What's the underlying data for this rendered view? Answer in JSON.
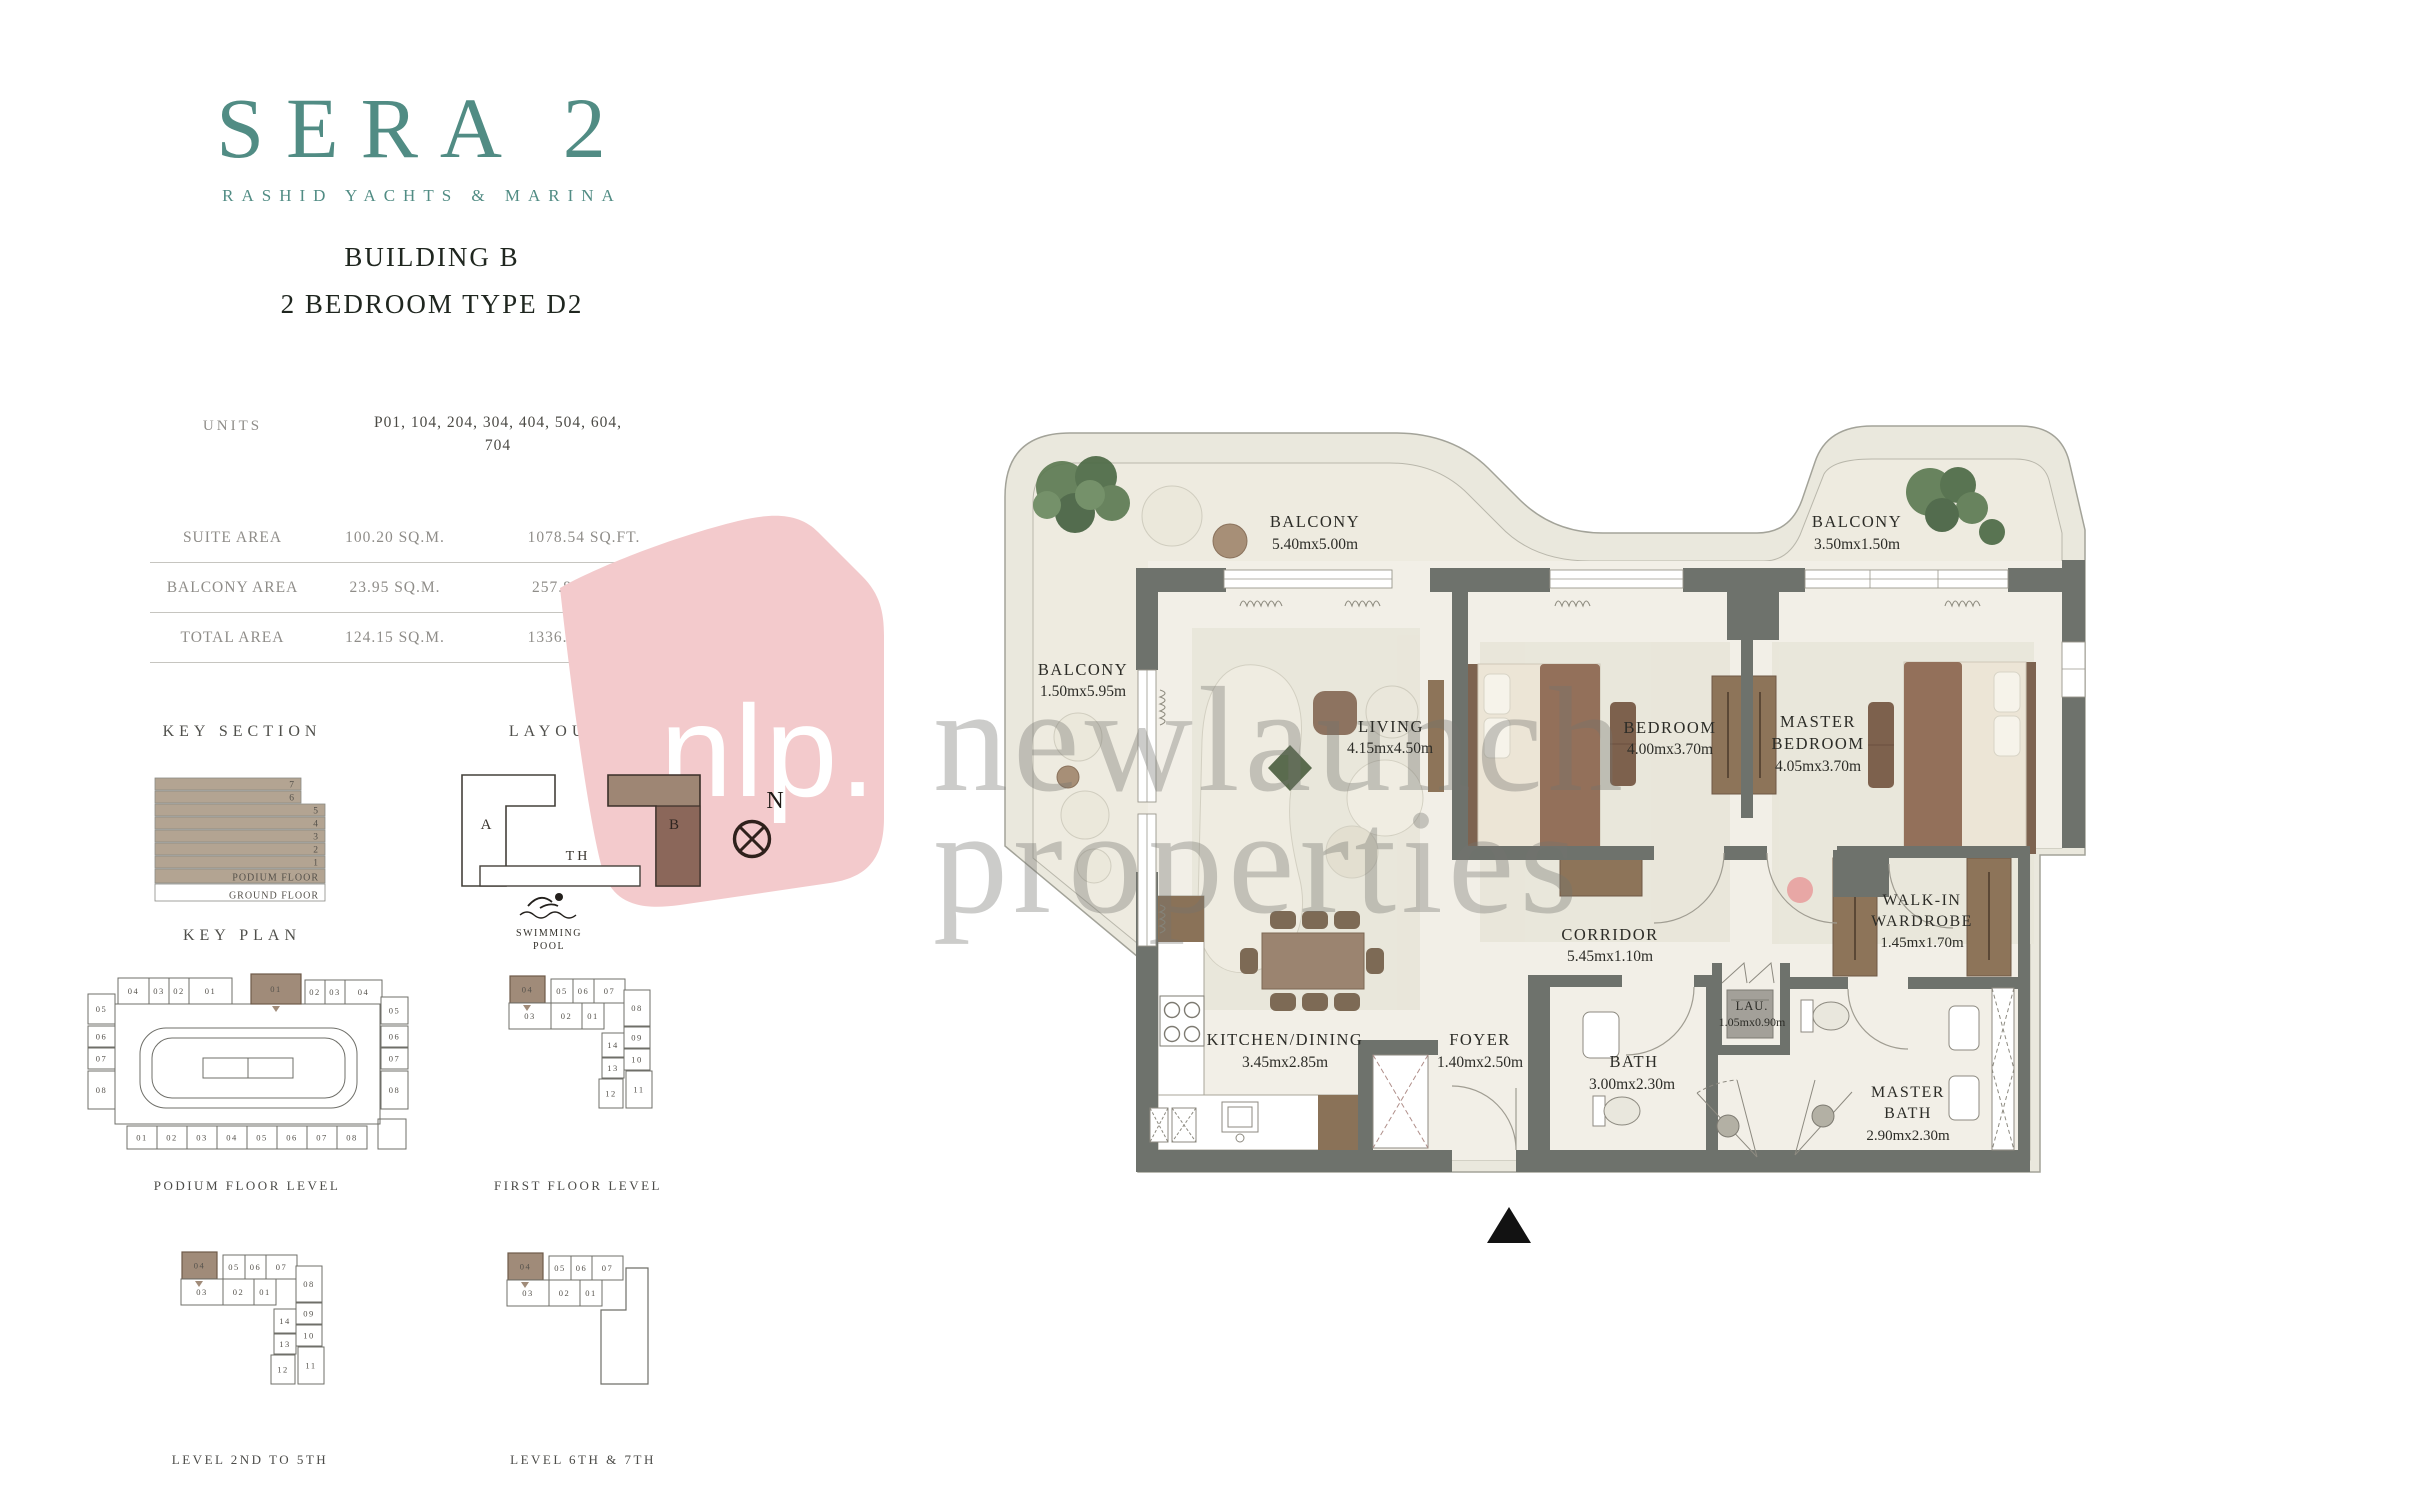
{
  "brand": {
    "logo": "SERA 2",
    "tagline": "RASHID YACHTS & MARINA",
    "accent_color": "#518c84"
  },
  "title": {
    "line1": "BUILDING B",
    "line2": "2 BEDROOM TYPE D2"
  },
  "units": {
    "label": "UNITS",
    "value_line1": "P01, 104, 204, 304, 404, 504, 604,",
    "value_line2": "704"
  },
  "area_table": {
    "rows": [
      {
        "label": "SUITE AREA",
        "sqm": "100.20 SQ.M.",
        "sqft": "1078.54 SQ.FT."
      },
      {
        "label": "BALCONY AREA",
        "sqm": "23.95 SQ.M.",
        "sqft": "257.80 SQ.FT."
      },
      {
        "label": "TOTAL AREA",
        "sqm": "124.15 SQ.M.",
        "sqft": "1336.34 SQ.FT."
      }
    ]
  },
  "key_section": {
    "header": "KEY SECTION",
    "floors": [
      "7",
      "6",
      "5",
      "4",
      "3",
      "2",
      "1",
      "PODIUM FLOOR",
      "GROUND FLOOR"
    ],
    "bar_color": "#b3a492"
  },
  "layout": {
    "header": "LAYOUT",
    "building_a": "A",
    "building_b": "B",
    "th": "TH",
    "pool_line1": "SWIMMING",
    "pool_line2": "POOL"
  },
  "compass": {
    "label": "N"
  },
  "key_plan": {
    "header": "KEY PLAN",
    "highlight_color": "#a08b79",
    "podium": {
      "caption": "PODIUM FLOOR LEVEL",
      "top_left": [
        "04",
        "03",
        "02",
        "01"
      ],
      "top_right": [
        "01",
        "02",
        "03",
        "04"
      ],
      "left": [
        "05",
        "06",
        "07",
        "08"
      ],
      "right": [
        "05",
        "06",
        "07",
        "08"
      ],
      "bottom": [
        "01",
        "02",
        "03",
        "04",
        "05",
        "06",
        "07",
        "08"
      ]
    },
    "first": {
      "caption": "FIRST FLOOR LEVEL",
      "row1": [
        "04",
        "05",
        "06",
        "07"
      ],
      "row2": [
        "03",
        "02",
        "01"
      ],
      "right": [
        "08",
        "09",
        "10",
        "11"
      ],
      "mid": [
        "14",
        "13",
        "12"
      ]
    },
    "level2to5": {
      "caption": "LEVEL 2ND TO 5TH",
      "row1": [
        "04",
        "05",
        "06",
        "07"
      ],
      "row2": [
        "03",
        "02",
        "01"
      ],
      "right": [
        "08",
        "09",
        "10",
        "11"
      ],
      "mid": [
        "14",
        "13",
        "12"
      ]
    },
    "level6and7": {
      "caption": "LEVEL 6TH & 7TH",
      "row1": [
        "04",
        "05",
        "06",
        "07"
      ],
      "row2": [
        "03",
        "02",
        "01"
      ]
    }
  },
  "plan": {
    "rooms": [
      {
        "id": "balcony-top-left",
        "name": "BALCONY",
        "dims": "5.40mx5.00m"
      },
      {
        "id": "balcony-left",
        "name": "BALCONY",
        "dims": "1.50mx5.95m"
      },
      {
        "id": "balcony-top-right",
        "name": "BALCONY",
        "dims": "3.50mx1.50m"
      },
      {
        "id": "living",
        "name": "LIVING",
        "dims": "4.15mx4.50m"
      },
      {
        "id": "bedroom",
        "name": "BEDROOM",
        "dims": "4.00mx3.70m"
      },
      {
        "id": "master-bedroom",
        "name": "MASTER",
        "name2": "BEDROOM",
        "dims": "4.05mx3.70m"
      },
      {
        "id": "kitchen-dining",
        "name": "KITCHEN/DINING",
        "dims": "3.45mx2.85m"
      },
      {
        "id": "foyer",
        "name": "FOYER",
        "dims": "1.40mx2.50m"
      },
      {
        "id": "corridor",
        "name": "CORRIDOR",
        "dims": "5.45mx1.10m"
      },
      {
        "id": "bath",
        "name": "BATH",
        "dims": "3.00mx2.30m"
      },
      {
        "id": "laundry",
        "name": "LAU.",
        "dims": "1.05mx0.90m"
      },
      {
        "id": "walk-in-wardrobe",
        "name": "WALK-IN",
        "name2": "WARDROBE",
        "dims": "1.45mx1.70m"
      },
      {
        "id": "master-bath",
        "name": "MASTER",
        "name2": "BATH",
        "dims": "2.90mx2.30m"
      }
    ]
  },
  "watermarks": {
    "nlp": "nlp.",
    "text_line1": "newlaunch",
    "text_line2": "properties",
    "bubble_color": "#f3cacc",
    "dot_color": "#e89b9b"
  }
}
